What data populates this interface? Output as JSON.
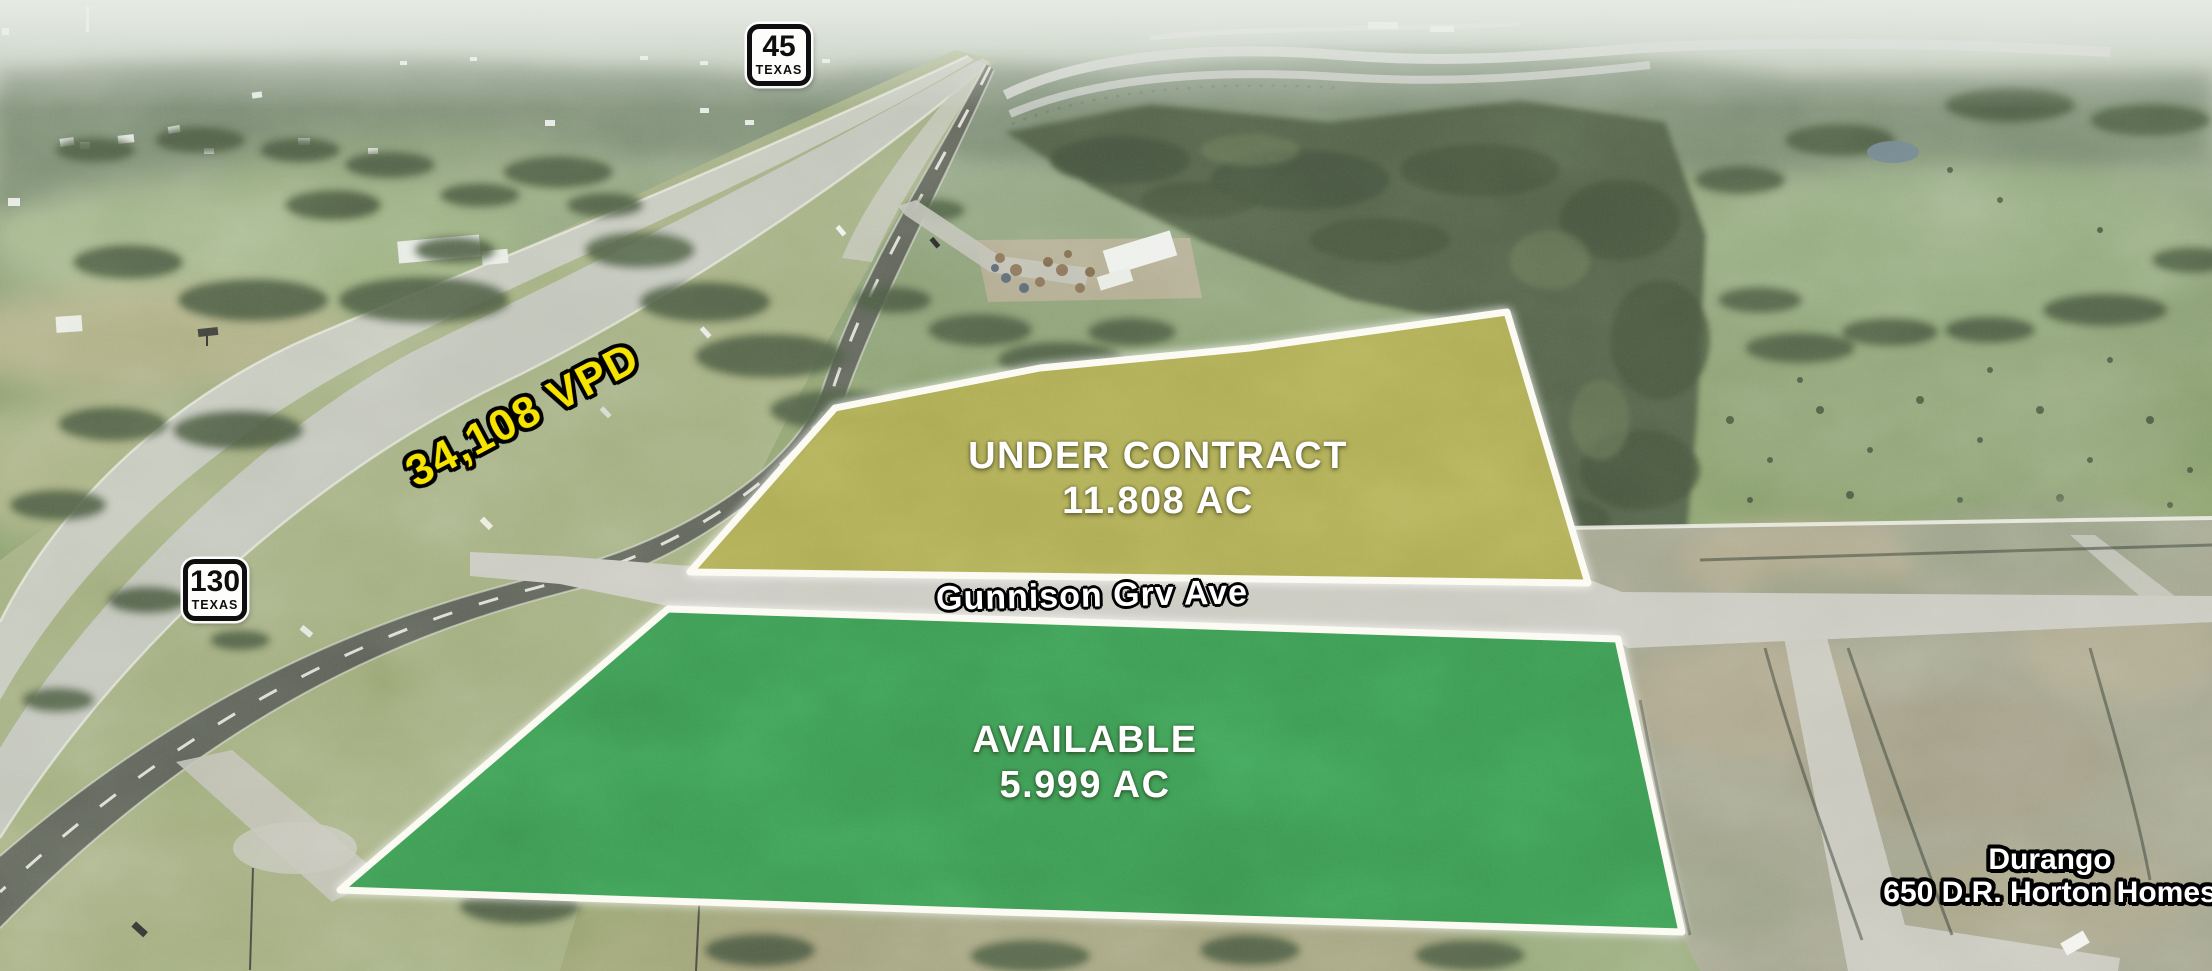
{
  "shields": {
    "sh45": {
      "route": "45",
      "state": "TEXAS"
    },
    "sh130": {
      "route": "130",
      "state": "TEXAS"
    }
  },
  "traffic": {
    "label": "34,108 VPD",
    "color": "#f6e400"
  },
  "parcels": {
    "under_contract": {
      "status": "UNDER CONTRACT",
      "area": "11.808 AC",
      "fill": "#a9a648",
      "border": "#fbfbf3"
    },
    "available": {
      "status": "AVAILABLE",
      "area": "5.999 AC",
      "fill": "#2e9345",
      "border": "#fbfbf3"
    }
  },
  "street": {
    "name": "Gunnison Grv Ave"
  },
  "development": {
    "name": "Durango",
    "builder": "650 D.R. Horton Homes"
  }
}
